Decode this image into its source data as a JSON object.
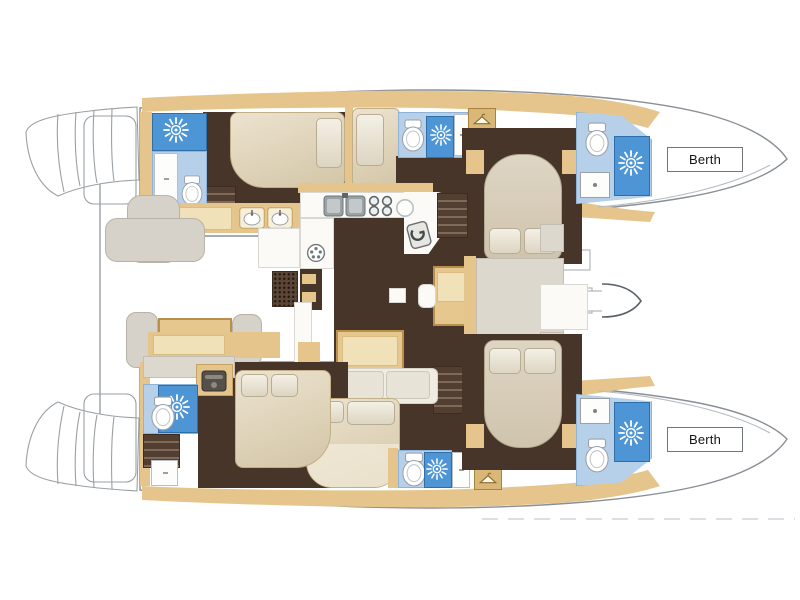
{
  "window": {
    "width": 800,
    "height": 600,
    "background": "#ffffff"
  },
  "diagram": {
    "kind": "catamaran-deck-floorplan",
    "labels": {
      "bow_top_berth": "Berth",
      "bow_bottom_berth": "Berth"
    },
    "palette": {
      "outline": "#8d9298",
      "wood_tan": "#e5c58c",
      "wood_tan_light": "#f1e1b8",
      "floor_dark_brown": "#483529",
      "shower_blue": "#4d95d4",
      "bath_floor_blue": "#b7d0ea",
      "bed_cream": "#ded5c4",
      "bench_gray": "#d6d1c9",
      "white_fixture": "#fbfaf7"
    },
    "icons": [
      "shower-sun-icon",
      "toilet-icon",
      "washbasin-icon",
      "sink-icon",
      "stove-burners-icon",
      "round-vent-icon",
      "coat-hanger-icon",
      "appliance-icon",
      "mast-chevron-icon"
    ],
    "areas": [
      "cockpit",
      "salon",
      "galley",
      "chart-table",
      "port-hull-aft-cabin",
      "port-hull-forward-cabin",
      "port-heads-with-shower",
      "starboard-hull-aft-cabin",
      "starboard-hull-forward-cabin",
      "starboard-heads-with-shower",
      "bow-berth-port",
      "bow-berth-starboard"
    ]
  }
}
